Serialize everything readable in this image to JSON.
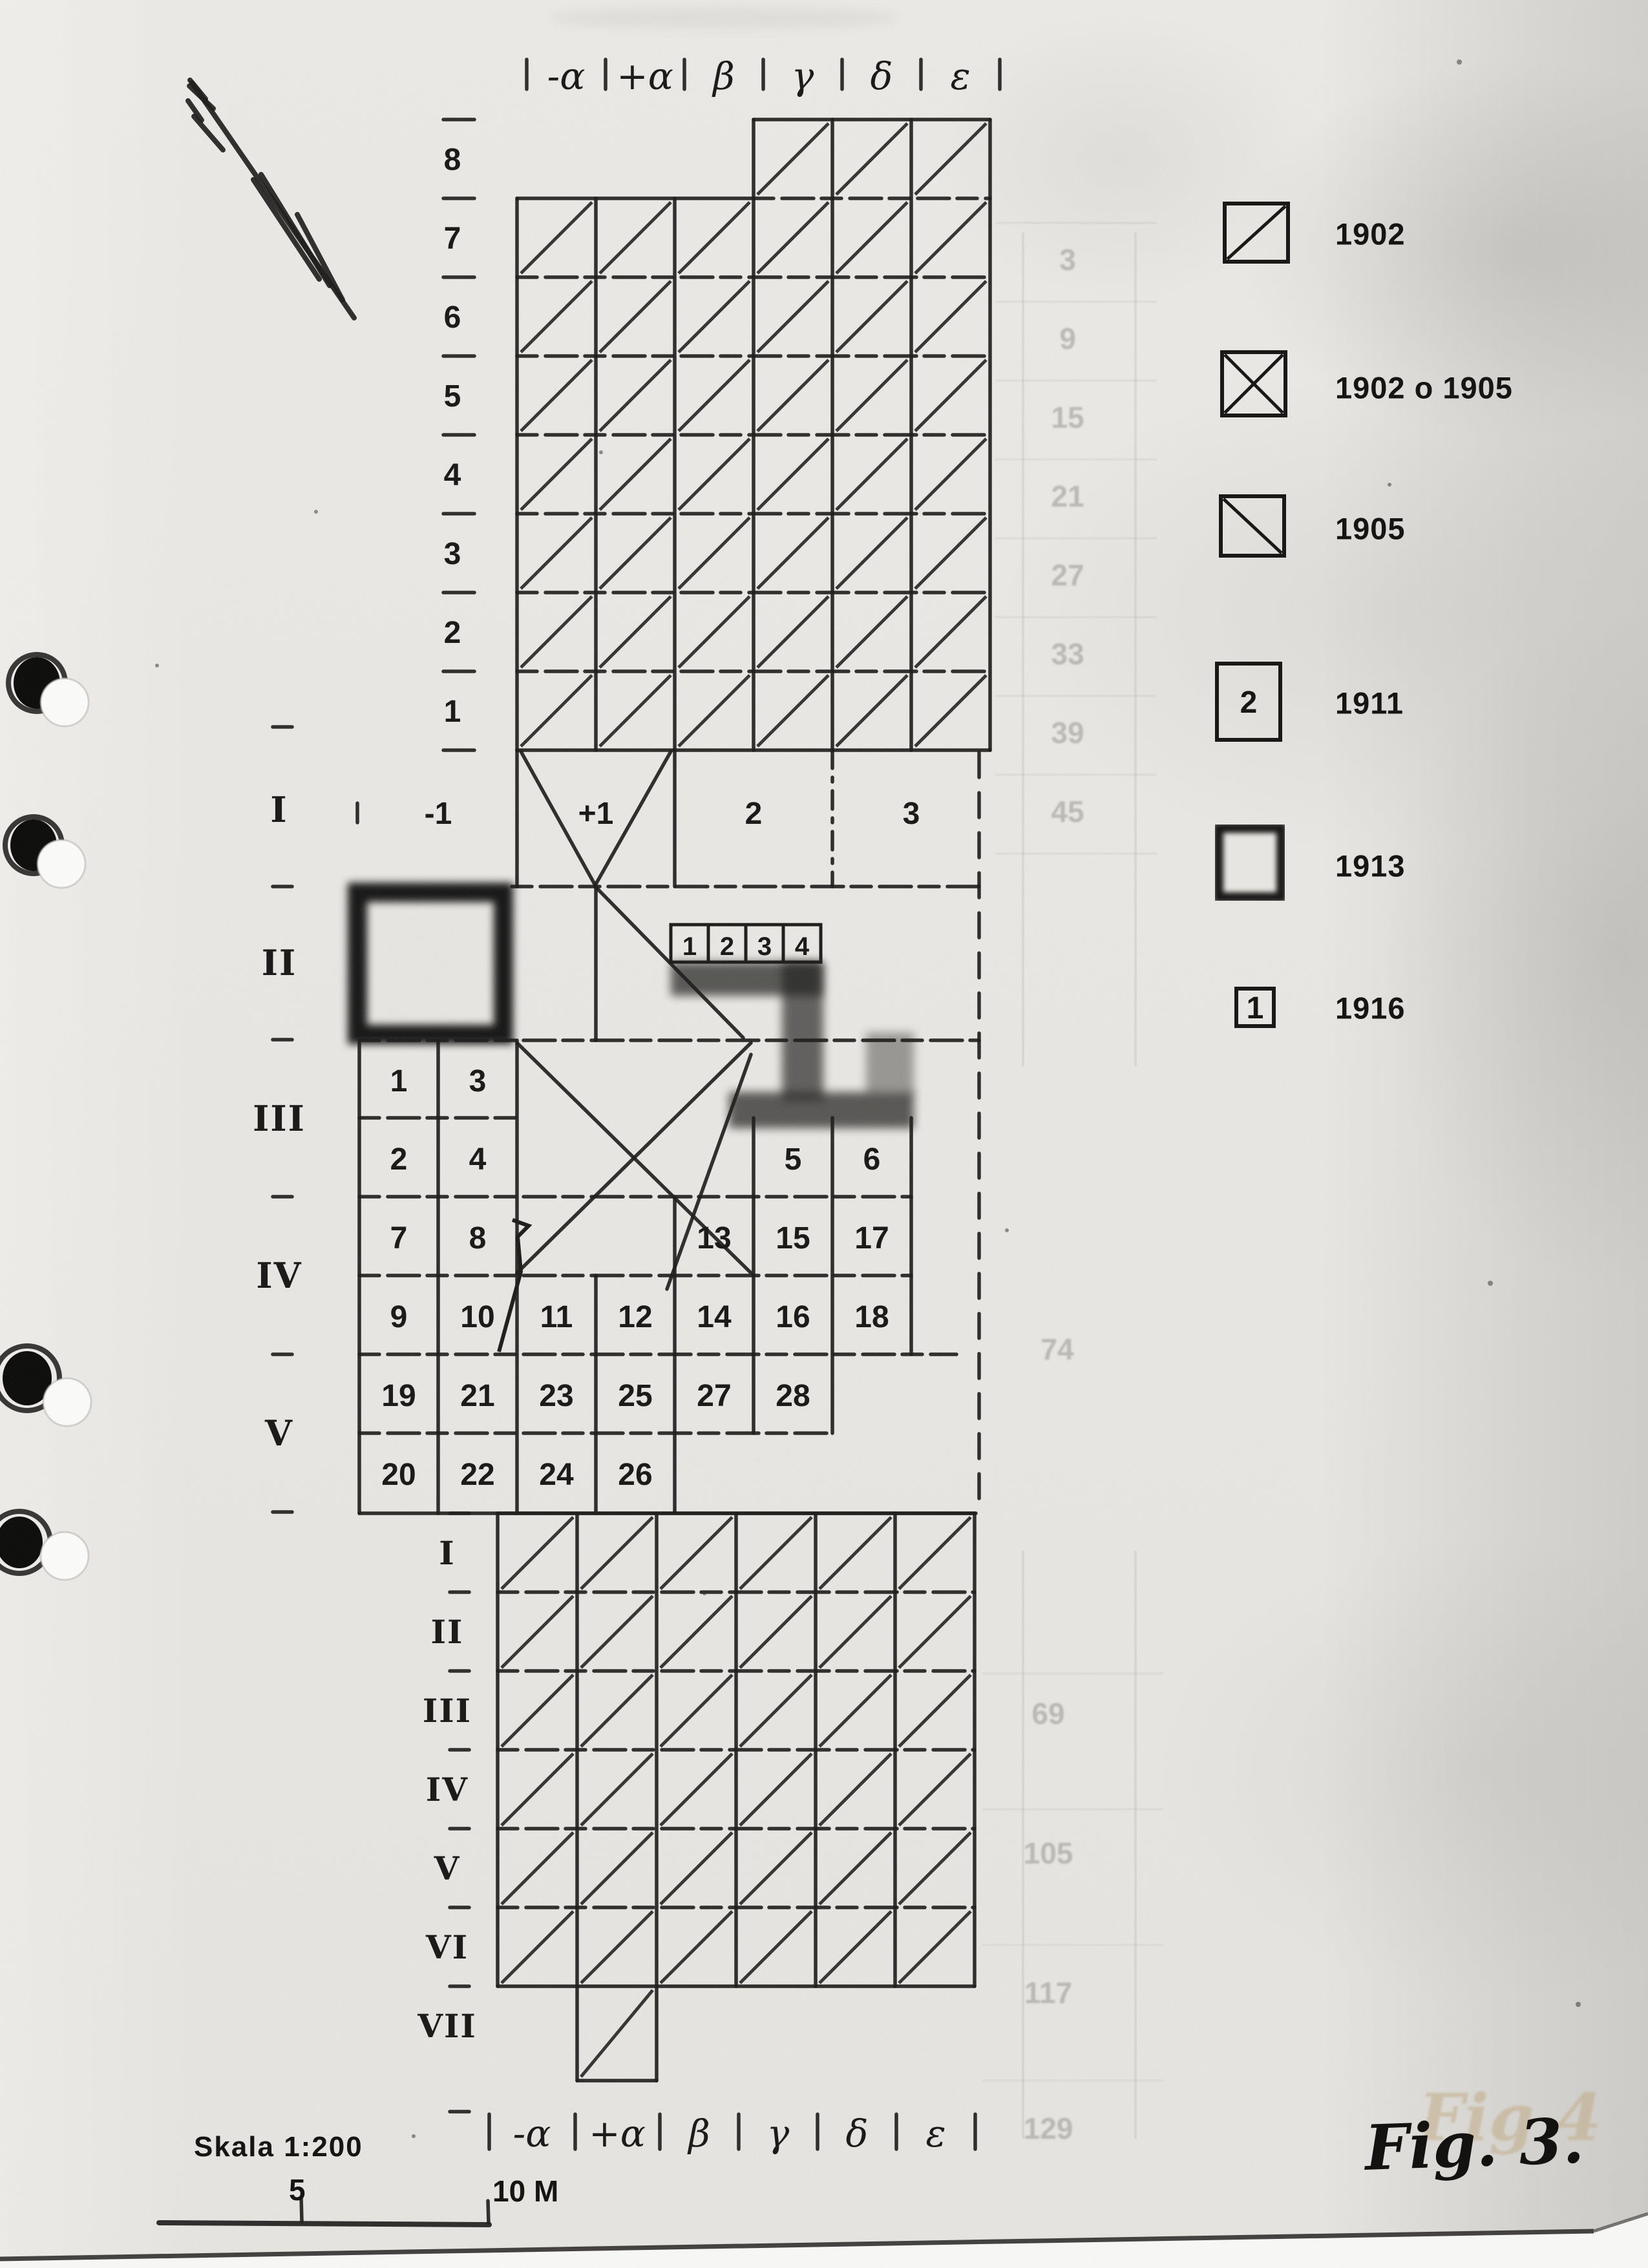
{
  "figure": {
    "caption": "Fig. 3.",
    "ghost_caption": "Fig 4",
    "scale_label": "Skala 1:200",
    "scale_mid_tick": "5",
    "scale_end_tick": "10 M"
  },
  "legend": {
    "items": [
      {
        "symbol": "diagonal-up-square",
        "symbol_text": "",
        "label": "1902"
      },
      {
        "symbol": "cross-square",
        "symbol_text": "",
        "label": "1902 o 1905"
      },
      {
        "symbol": "diagonal-down-square",
        "symbol_text": "",
        "label": "1905"
      },
      {
        "symbol": "numbered-square",
        "symbol_text": "2",
        "label": "1911"
      },
      {
        "symbol": "stippled-square",
        "symbol_text": "",
        "label": "1913"
      },
      {
        "symbol": "small-numbered-square",
        "symbol_text": "1",
        "label": "1916"
      }
    ]
  },
  "axis": {
    "top_labels": [
      "-α",
      "+α",
      "β",
      "γ",
      "δ",
      "ε"
    ],
    "bottom_labels": [
      "-α",
      "+α",
      "β",
      "γ",
      "δ",
      "ε"
    ],
    "row_numbers": [
      "8",
      "7",
      "6",
      "5",
      "4",
      "3",
      "2",
      "1"
    ],
    "upper_sections": [
      "I",
      "II",
      "III",
      "IV",
      "V"
    ],
    "lower_sections": [
      "I",
      "II",
      "III",
      "IV",
      "V",
      "VI",
      "VII"
    ],
    "offset_labels": [
      "-1",
      "+1",
      "2",
      "3"
    ]
  },
  "plan": {
    "small_cells": [
      "1",
      "2",
      "3",
      "4"
    ],
    "numbered_rows": [
      [
        "1",
        "3"
      ],
      [
        "2",
        "4",
        "5",
        "6"
      ],
      [
        "7",
        "8",
        "13",
        "15",
        "17"
      ],
      [
        "9",
        "10",
        "11",
        "12",
        "14",
        "16",
        "18"
      ],
      [
        "19",
        "21",
        "23",
        "25",
        "27",
        "28"
      ],
      [
        "20",
        "22",
        "24",
        "26"
      ]
    ]
  },
  "ghosts": {
    "right_column": [
      "3",
      "9",
      "15",
      "21",
      "27",
      "33",
      "39",
      "45"
    ],
    "mid": "74",
    "lower_column": [
      "69",
      "105",
      "117",
      "129"
    ]
  }
}
